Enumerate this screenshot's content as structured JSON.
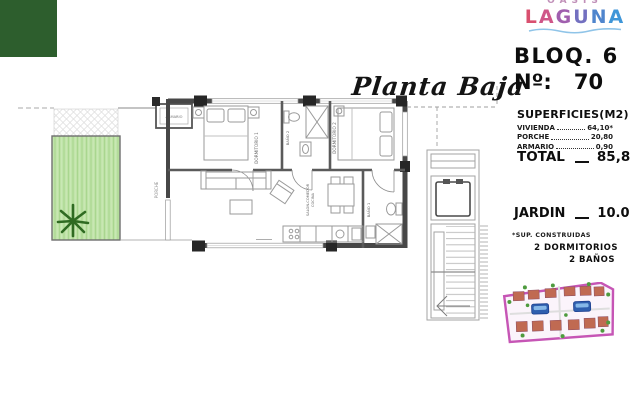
{
  "brand": {
    "top": "OASIS",
    "name": "LAGUNA"
  },
  "title": "Planta Baja",
  "unit": {
    "block": "BLOQ. 6",
    "number_label": "Nº:",
    "number": "70"
  },
  "surfaces": {
    "heading": "SUPERFICIES(M2)",
    "rows": [
      {
        "label": "VIVIENDA",
        "value": "64,10*"
      },
      {
        "label": "PORCHE",
        "value": "20,80"
      },
      {
        "label": "ARMARIO",
        "value": "0,90"
      }
    ],
    "total_label": "TOTAL",
    "total_value": "85,80"
  },
  "garden": {
    "label": "JARDIN",
    "value": "10.00"
  },
  "footnote": "*SUP. CONSTRUIDAS",
  "features": [
    "2 DORMITORIOS",
    "2 BAÑOS"
  ],
  "plan": {
    "rooms": {
      "dormitorio1": "DORMITORIO 1",
      "dormitorio2": "DORMITORIO 2",
      "bano1": "BAÑO 1",
      "bano2": "BAÑO 2",
      "salon": "SALON-COMEDOR",
      "cocina": "COCINA",
      "porche": "PORCHE",
      "armario": "ARMARIO"
    }
  },
  "colors": {
    "dark_green_square": "#2d5e2d",
    "garden_fill": "#bfe3a8",
    "palm_green": "#2f6b22",
    "wall_gray": "#474747",
    "logo_gradient_start": "#d9506f",
    "logo_gradient_end": "#3f96d8",
    "siteplan_outline": "#c655b5",
    "pool_blue": "#2f5fae"
  }
}
